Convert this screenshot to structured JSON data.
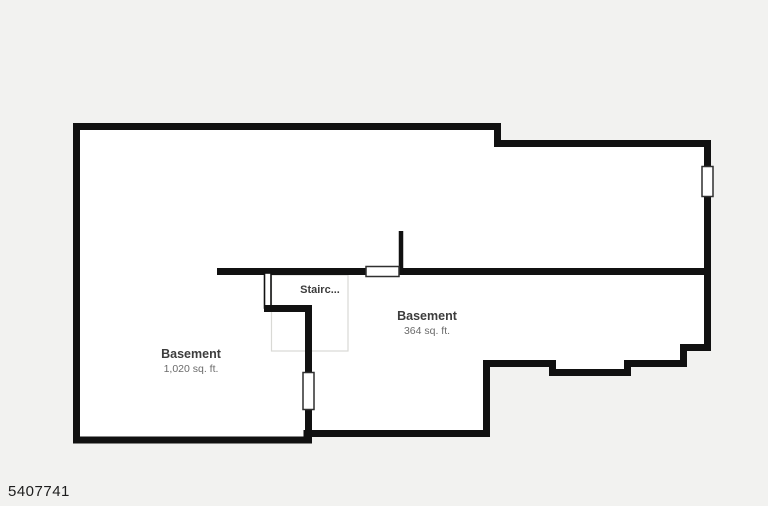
{
  "colors": {
    "background": "#f2f2f0",
    "floor": "#ffffff",
    "wall": "#111111",
    "room_label": "#3d3d3d",
    "area_label": "#6b6b6b",
    "stair_outline": "#d9d9d5",
    "window_border": "#2f2f2f",
    "id_text": "#1d1d1d"
  },
  "floorplan": {
    "id_label": "5407741",
    "staircase": {
      "label": "Stairc..."
    },
    "rooms": [
      {
        "name": "Basement",
        "area": "1,020 sq. ft."
      },
      {
        "name": "Basement",
        "area": "364 sq. ft."
      }
    ]
  }
}
